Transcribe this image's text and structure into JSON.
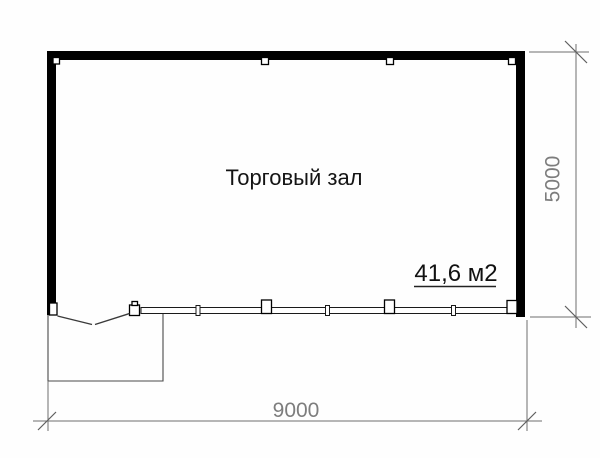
{
  "plan": {
    "room_label": "Торговый зал",
    "area_label": "41,6 м2",
    "width_dimension_label": "9000",
    "height_dimension_label": "5000"
  },
  "colors": {
    "wall": "#000000",
    "thin_line": "#3a3a3a",
    "dimension_line": "#6f6f6f",
    "dimension_text": "#7d7d7d",
    "label_text": "#141414",
    "background": "#fefefe"
  }
}
